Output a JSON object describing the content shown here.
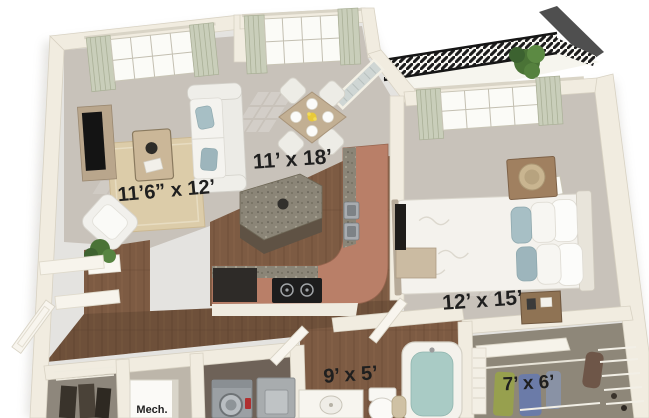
{
  "rooms": {
    "living": {
      "label": "11’6” x 12’"
    },
    "great": {
      "label": "11’ x 18’"
    },
    "bedroom": {
      "label": "12’ x 15’"
    },
    "bathroom": {
      "label": "9’ x 5’"
    },
    "closet": {
      "label": "7’ x 6’"
    },
    "mech": {
      "label": "Mech."
    }
  },
  "palette": {
    "wall": "#f1ece0",
    "carpet": "#c8c2ba",
    "wood": "#7d5b43",
    "wood_dark": "#6b4b37",
    "counter": "#b97f68",
    "granite": "#8b8577",
    "railing": "#1c1c1c",
    "plant": "#4a7336",
    "water": "#a9cbc5",
    "pillow_blue": "#a7bfc5",
    "rug": "#dccca9",
    "label": "#1f1f1f"
  }
}
